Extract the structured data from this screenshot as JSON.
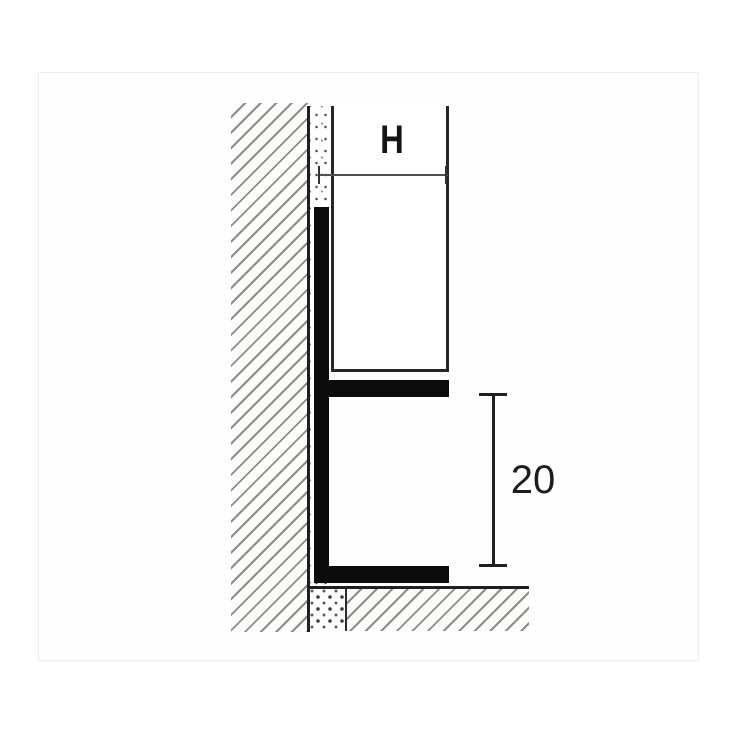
{
  "drawing": {
    "labels": {
      "height_dimension": "H",
      "reveal_dimension": "20"
    },
    "colors": {
      "background": "#ffffff",
      "outline": "#1f1f1f",
      "profile_fill": "#0b0b0b",
      "hatch_stroke": "#8f8c85",
      "dimension_line": "#4f4f4f",
      "text": "#161616"
    }
  }
}
